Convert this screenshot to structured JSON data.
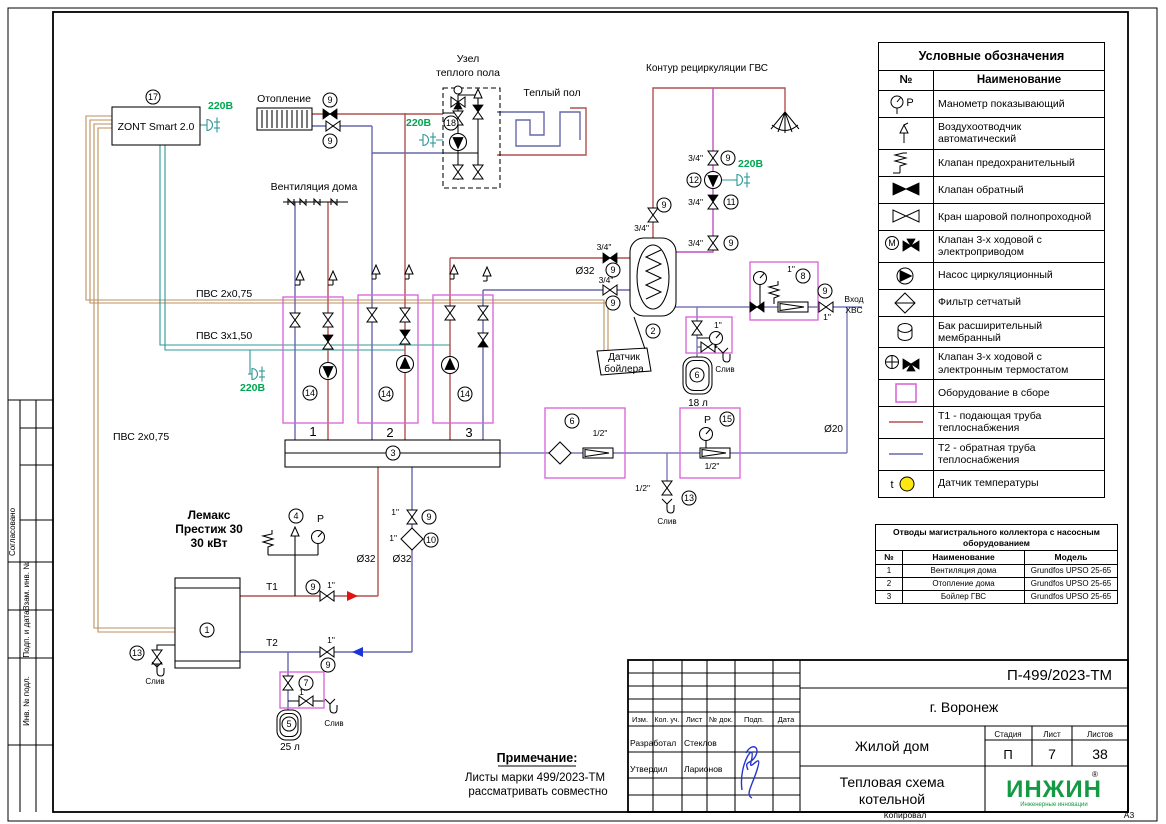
{
  "colors": {
    "t1": "#b25050",
    "t2": "#6668aa",
    "dhw": "#c24fc2",
    "cold": "#7a7ab8",
    "signal_wire": "#bb8f5f",
    "power_wire": "#2f9898",
    "power_text": "#00a651",
    "assembly_box": "#d95fd9",
    "arrow_red": "#e51212",
    "arrow_blue": "#1a35d6",
    "sensor_yellow": "#ffe712",
    "logo_green": "#149a43",
    "signature_blue": "#2636c8"
  },
  "page": {
    "copied_label": "Копировал",
    "format_label": "А3"
  },
  "sidebar": {
    "agreed": "Согласовано",
    "sections": [
      "Взам. инв. №",
      "Подп. и дата",
      "Инв. № подл."
    ]
  },
  "legend": {
    "title": "Условные обозначения",
    "col_no": "№",
    "col_name": "Наименование",
    "chars": {
      "p": "P",
      "m": "М",
      "t": "t"
    },
    "rows": [
      {
        "symbol": "gauge",
        "name": "Манометр показывающий"
      },
      {
        "symbol": "airvent",
        "name": "Воздухоотводчик автоматический"
      },
      {
        "symbol": "safety",
        "name": "Клапан предохранительный"
      },
      {
        "symbol": "check",
        "name": "Клапан обратный"
      },
      {
        "symbol": "ball",
        "name": "Кран шаровой полнопроходной"
      },
      {
        "symbol": "motor3way",
        "name": "Клапан 3-х ходовой с электроприводом"
      },
      {
        "symbol": "pump",
        "name": "Насос циркуляционный"
      },
      {
        "symbol": "strainer",
        "name": "Фильтр сетчатый"
      },
      {
        "symbol": "tank",
        "name": "Бак расширительный мембранный"
      },
      {
        "symbol": "thermo3way",
        "name": "Клапан 3-х ходовой с электронным термостатом"
      },
      {
        "symbol": "assembly",
        "name": "Оборудование в сборе"
      },
      {
        "symbol": "t1line",
        "name": "Т1 - подающая труба теплоснабжения"
      },
      {
        "symbol": "t2line",
        "name": "Т2 - обратная труба теплоснабжения"
      },
      {
        "symbol": "sensor",
        "name": "Датчик температуры"
      }
    ]
  },
  "pump_table": {
    "title": "Отводы магистрального коллектора с насосным оборудованием",
    "headers": [
      "№",
      "Наименование",
      "Модель"
    ],
    "rows": [
      [
        "1",
        "Вентиляция дома",
        "Grundfos UPSO 25-65"
      ],
      [
        "2",
        "Отопление дома",
        "Grundfos UPSO 25-65"
      ],
      [
        "3",
        "Бойлер ГВС",
        "Grundfos UPSO 25-65"
      ]
    ]
  },
  "title_block": {
    "doc_number": "П-499/2023-ТМ",
    "city": "г. Воронеж",
    "object_name": "Жилой дом",
    "sheet_title_line1": "Тепловая схема",
    "sheet_title_line2": "котельной",
    "stage_label": "Стадия",
    "sheet_label": "Лист",
    "sheets_label": "Листов",
    "stage": "П",
    "sheet": "7",
    "sheets": "38",
    "cols": [
      "Изм.",
      "Кол. уч.",
      "Лист",
      "№ док.",
      "Подп.",
      "Дата"
    ],
    "developed_label": "Разработал",
    "developed_by": "Стеклов",
    "approved_label": "Утвердил",
    "approved_by": "Ларионов",
    "logo_text": "ИНЖИН",
    "logo_r": "®",
    "logo_sub": "Инженерные инновации"
  },
  "note": {
    "heading": "Примечание:",
    "line1": "Листы марки 499/2023-ТМ",
    "line2": "рассматривать совместно"
  },
  "schematic": {
    "labels": {
      "zont": "ZONT Smart 2.0",
      "v220": "220В",
      "heating": "Отопление",
      "floor_node_line1": "Узел",
      "floor_node_line2": "теплого пола",
      "warm_floor": "Теплый пол",
      "gvs_loop": "Контур рециркуляции ГВС",
      "house_vent": "Вентиляция дома",
      "pvs2": "ПВС 2х0,75",
      "pvs3": "ПВС 3х1,50",
      "boiler_line1": "Лемакс",
      "boiler_line2": "Престиж 30",
      "boiler_line3": "30 кВт",
      "t1": "Т1",
      "t2": "Т2",
      "d32": "Ø32",
      "d20": "Ø20",
      "d34": "3/4\"",
      "d1": "1\"",
      "d12": "1/2\"",
      "drain": "Слив",
      "inlet_line1": "Вход",
      "inlet_line2": "ХВС",
      "vol25": "25 л",
      "vol18": "18 л",
      "sensor_line1": "Датчик",
      "sensor_line2": "бойлера",
      "p": "P",
      "group1": "1",
      "group2": "2",
      "group3": "3"
    },
    "tags": [
      {
        "n": "17",
        "x": 153,
        "y": 97
      },
      {
        "n": "9",
        "x": 330,
        "y": 100
      },
      {
        "n": "9",
        "x": 330,
        "y": 141
      },
      {
        "n": "18",
        "x": 451,
        "y": 123
      },
      {
        "n": "9",
        "x": 728,
        "y": 158
      },
      {
        "n": "12",
        "x": 694,
        "y": 180
      },
      {
        "n": "11",
        "x": 731,
        "y": 202
      },
      {
        "n": "9",
        "x": 731,
        "y": 243
      },
      {
        "n": "9",
        "x": 664,
        "y": 205
      },
      {
        "n": "2",
        "x": 653,
        "y": 331
      },
      {
        "n": "9",
        "x": 613,
        "y": 270
      },
      {
        "n": "9",
        "x": 613,
        "y": 303
      },
      {
        "n": "8",
        "x": 803,
        "y": 276
      },
      {
        "n": "9",
        "x": 825,
        "y": 291
      },
      {
        "n": "6",
        "x": 697,
        "y": 375
      },
      {
        "n": "13",
        "x": 137,
        "y": 653
      },
      {
        "n": "1",
        "x": 207,
        "y": 630
      },
      {
        "n": "4",
        "x": 296,
        "y": 516
      },
      {
        "n": "9",
        "x": 313,
        "y": 587
      },
      {
        "n": "14",
        "x": 310,
        "y": 393
      },
      {
        "n": "14",
        "x": 386,
        "y": 394
      },
      {
        "n": "14",
        "x": 465,
        "y": 394
      },
      {
        "n": "3",
        "x": 393,
        "y": 453
      },
      {
        "n": "9",
        "x": 429,
        "y": 517
      },
      {
        "n": "10",
        "x": 431,
        "y": 540
      },
      {
        "n": "9",
        "x": 328,
        "y": 665
      },
      {
        "n": "5",
        "x": 289,
        "y": 724
      },
      {
        "n": "7",
        "x": 306,
        "y": 683
      },
      {
        "n": "13",
        "x": 689,
        "y": 498
      },
      {
        "n": "15",
        "x": 727,
        "y": 419
      },
      {
        "n": "6",
        "x": 572,
        "y": 421
      }
    ]
  }
}
